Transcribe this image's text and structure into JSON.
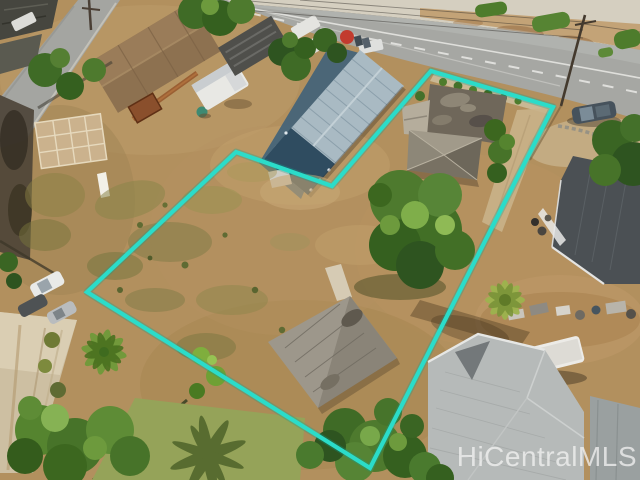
{
  "scene": {
    "type": "aerial-drone-real-estate-photo",
    "subject": "vacant-residential-lot-outlined"
  },
  "watermark": {
    "text": "HiCentralMLS",
    "color": "rgba(243,243,243,0.75)"
  },
  "boundary": {
    "points": "431,71 553,107 370,468 87,292 236,152 332,186",
    "color": "#2bdcc9",
    "stroke_width": "4.2"
  },
  "colors": {
    "dirt": "#b2905e",
    "asphalt": "#a6a7a3",
    "foliage": "#4e7a2e",
    "boundary_teal": "#2bdcc9",
    "blue_house_roof": "#a9bac3",
    "old_house_roof": "#6f675a",
    "right_house_roof": "#4b5054",
    "bottom_right_roof": "#b6bab9"
  }
}
